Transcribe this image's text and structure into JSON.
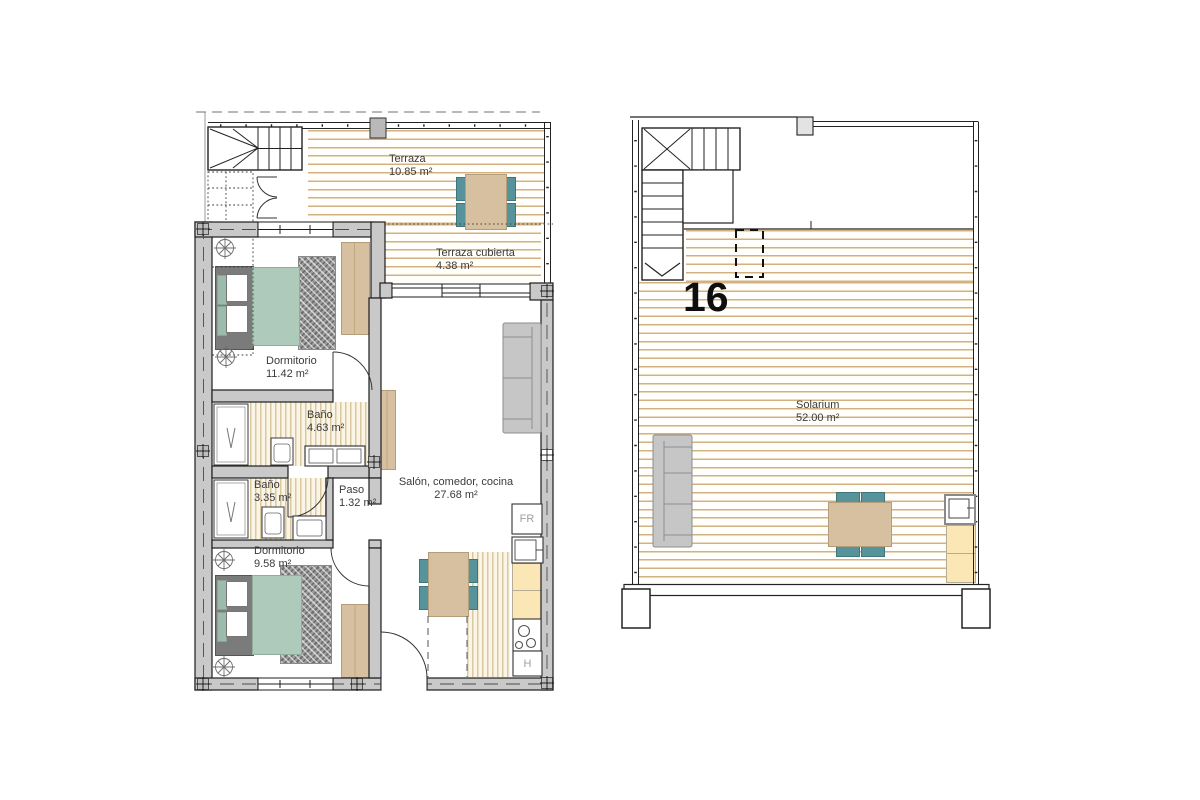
{
  "plan_title": "floor-plan",
  "left": {
    "rooms": {
      "terraza": {
        "name": "Terraza",
        "area": "10.85 m²"
      },
      "terraza_cubierta": {
        "name": "Terraza cubierta",
        "area": "4.38 m²"
      },
      "dormitorio1": {
        "name": "Dormitorio",
        "area": "11.42 m²"
      },
      "bano1": {
        "name": "Baño",
        "area": "4.63 m²"
      },
      "bano2": {
        "name": "Baño",
        "area": "3.35 m²"
      },
      "paso": {
        "name": "Paso",
        "area": "1.32 m²"
      },
      "dormitorio2": {
        "name": "Dormitorio",
        "area": "9.58 m²"
      },
      "salon": {
        "name": "Salón, comedor, cocina",
        "area": "27.68 m²"
      }
    },
    "appliances": {
      "fridge": "FR",
      "oven": "H"
    }
  },
  "right": {
    "unit_number": "16",
    "rooms": {
      "solarium": {
        "name": "Solarium",
        "area": "52.00 m²"
      }
    }
  },
  "colors": {
    "deck_line": "#d0b283",
    "tile_line": "#d9c8a0",
    "wall": "#c9c9c9",
    "bed": "#aecabb",
    "chair": "#57939b",
    "wood": "#d7c0a0",
    "counter": "#fbe7b5",
    "sofa": "#c6c6c6"
  }
}
